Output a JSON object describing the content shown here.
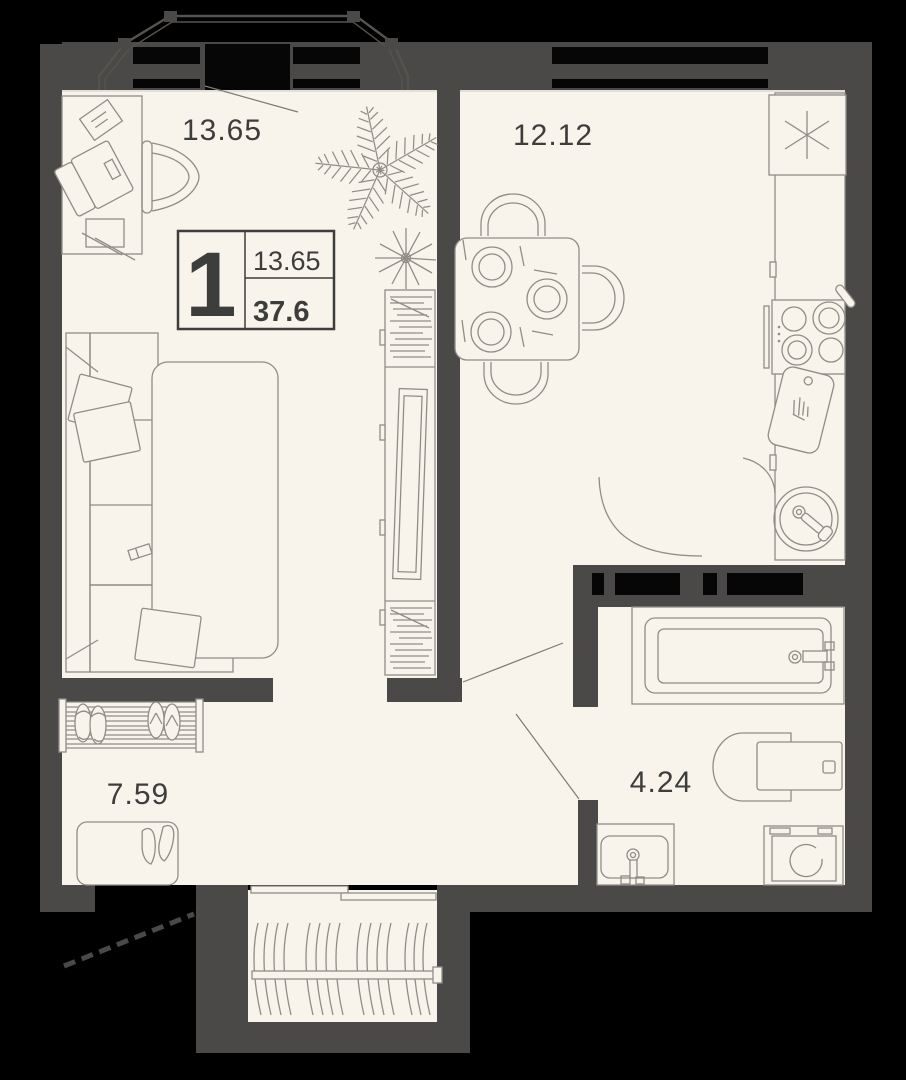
{
  "plan": {
    "type": "apartment-floor-plan",
    "badge": {
      "rooms_count": "1",
      "room_area": "13.65",
      "total_area": "37.6"
    },
    "rooms": {
      "living": {
        "label": "13.65"
      },
      "kitchen": {
        "label": "12.12"
      },
      "hallway": {
        "label": "7.59"
      },
      "bathroom": {
        "label": "4.24"
      }
    },
    "colors": {
      "outside": "#000000",
      "wall": "#4a4947",
      "floor": "#f8f4ec",
      "furniture_outline": "#8f8d86",
      "text": "#3d3d3b"
    },
    "furniture_icons": [
      "sofa-bed",
      "pillows",
      "wardrobe",
      "desk",
      "laptop",
      "notepad",
      "desk-chair",
      "plant-large",
      "plant-small",
      "dining-table",
      "dining-chairs",
      "plates",
      "fridge",
      "kitchen-counter",
      "stove",
      "pan",
      "cutting-board",
      "kitchen-sink",
      "bathtub",
      "toilet",
      "washbasin",
      "washing-machine",
      "shoe-rack",
      "shoes",
      "door-mat",
      "heels",
      "drying-rack",
      "balcony-railing"
    ]
  }
}
